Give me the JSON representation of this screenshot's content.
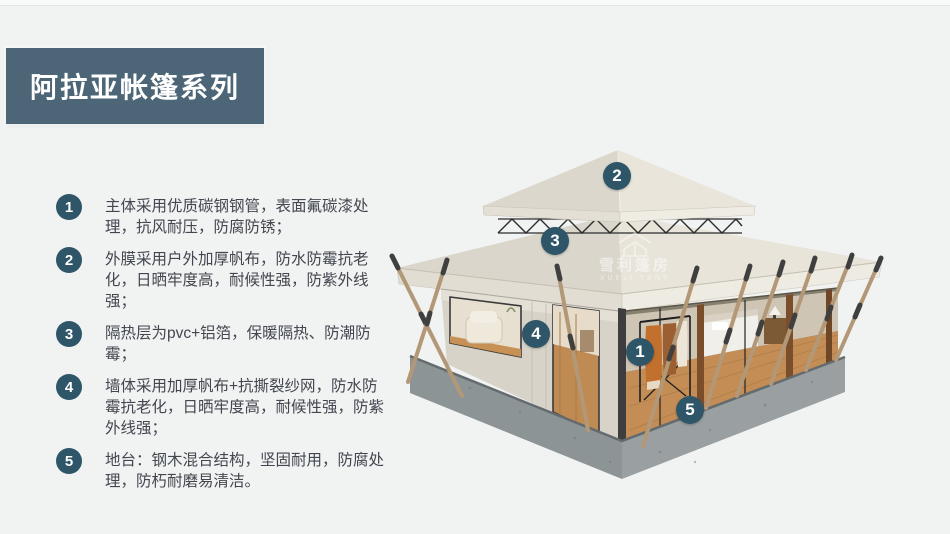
{
  "page": {
    "background": "#f1f2f2"
  },
  "colors": {
    "accent": "#2e5568",
    "banner_bg": "#4c6577",
    "text": "#42474f",
    "roof_light": "#e9e5db",
    "roof_dark": "#dbd6cb",
    "canvas_wall": "#d7d3c9",
    "wood_floor": "#c38d55",
    "platform_gray": "#939a9c"
  },
  "banner": {
    "title": "阿拉亚帐篷系列"
  },
  "features": [
    {
      "num": "1",
      "text": "主体采用优质碳钢钢管，表面氟碳漆处理，抗风耐压，防腐防锈；"
    },
    {
      "num": "2",
      "text": "外膜采用户外加厚帆布，防水防霉抗老化，日晒牢度高，耐候性强，防紫外线强；"
    },
    {
      "num": "3",
      "text": "隔热层为pvc+铝箔，保暖隔热、防潮防霉；"
    },
    {
      "num": "4",
      "text": "墙体采用加厚帆布+抗撕裂纱网，防水防霉抗老化，日晒牢度高，耐候性强，防紫外线强；"
    },
    {
      "num": "5",
      "text": "地台：钢木混合结构，坚固耐用，防腐处理，防朽耐磨易清洁。"
    }
  ],
  "tent_markers": [
    {
      "num": "2",
      "x": 617,
      "y": 176
    },
    {
      "num": "3",
      "x": 555,
      "y": 241
    },
    {
      "num": "4",
      "x": 536,
      "y": 334
    },
    {
      "num": "1",
      "x": 640,
      "y": 352
    },
    {
      "num": "5",
      "x": 690,
      "y": 410
    }
  ],
  "watermark": {
    "name": "雪利篷房",
    "subtitle": "XUELI TENT"
  }
}
